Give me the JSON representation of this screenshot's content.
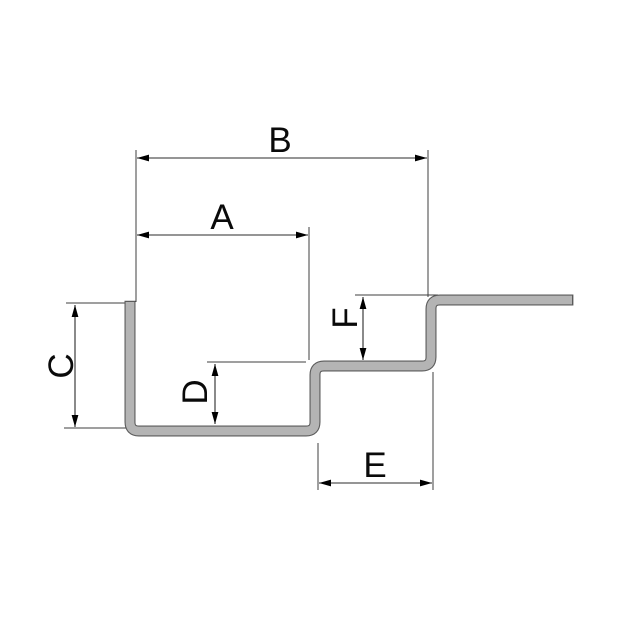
{
  "diagram": {
    "kind": "stepped-profile-dimension-drawing",
    "labels": {
      "A": "A",
      "B": "B",
      "C": "C",
      "D": "D",
      "E": "E",
      "F": "F"
    },
    "dimension_lines": [
      {
        "label": "B",
        "orientation": "horizontal"
      },
      {
        "label": "A",
        "orientation": "horizontal"
      },
      {
        "label": "C",
        "orientation": "vertical"
      },
      {
        "label": "D",
        "orientation": "vertical"
      },
      {
        "label": "F",
        "orientation": "vertical"
      },
      {
        "label": "E",
        "orientation": "horizontal"
      }
    ],
    "colors": {
      "background": "#ffffff",
      "profile_fill": "#b4b4b4",
      "profile_outline": "#5a5a5a",
      "dimension_line": "#2b2b2b",
      "extension_line": "#3f3f3f",
      "label_text": "#0a0a0a",
      "arrowhead": "#000000"
    }
  }
}
